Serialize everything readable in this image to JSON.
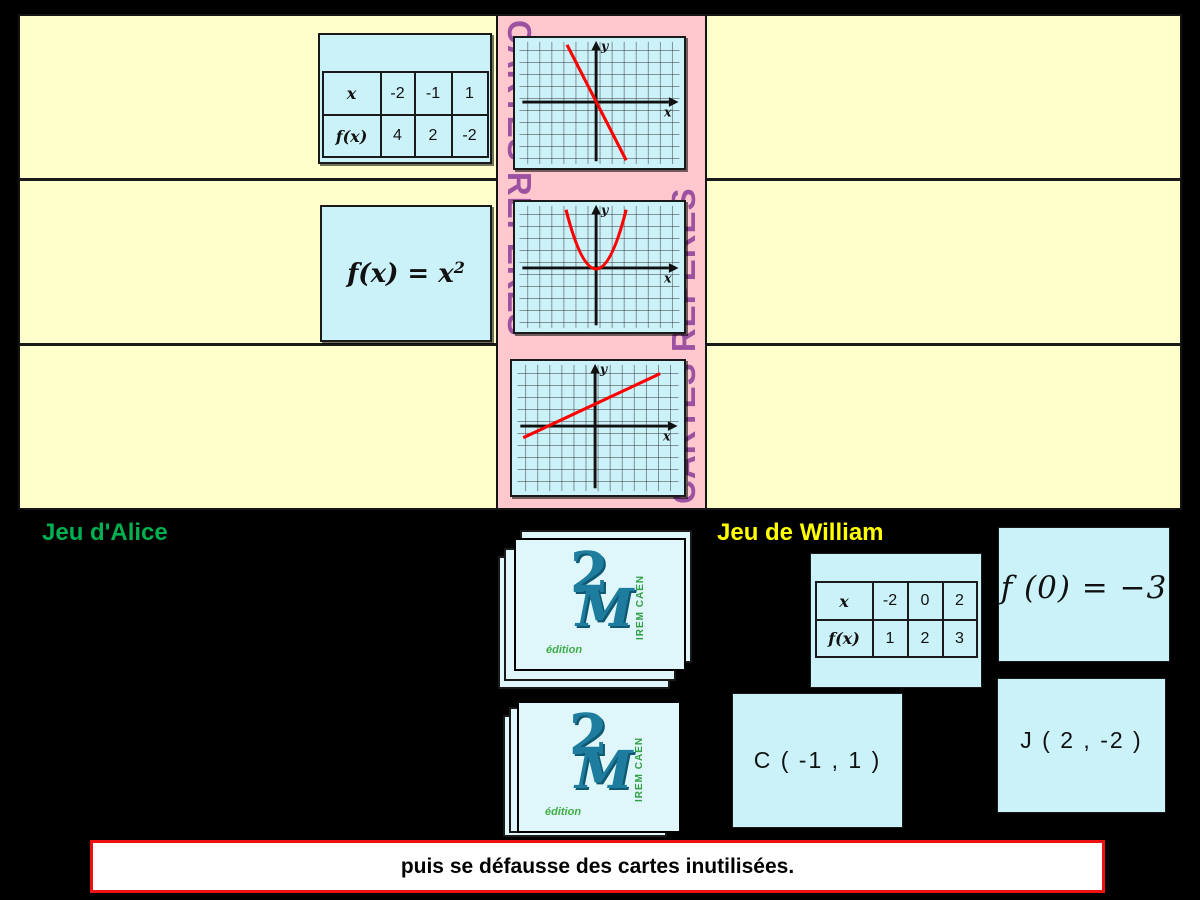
{
  "titles": {
    "alice": "Jeu d'Alice",
    "william": "Jeu de William"
  },
  "center_column": {
    "left_vertical_text": "CARTES REPÈRES",
    "right_vertical_text": "CARTES REPÈRES"
  },
  "board": {
    "row1_table": {
      "header_row": [
        "x",
        "-2",
        "-1",
        "1"
      ],
      "value_row": [
        "f(x)",
        "4",
        "2",
        "-2"
      ]
    },
    "row2_formula": {
      "base": "f(x) = x",
      "exponent": "2"
    }
  },
  "graphs": {
    "x_label": "x",
    "y_label": "y",
    "row1": {
      "type": "line",
      "trend": "steep decreasing line through origin",
      "points_grid": [
        [
          -2.4,
          4.8
        ],
        [
          2.5,
          -4.8
        ]
      ]
    },
    "row2": {
      "type": "parabola",
      "opens": "up",
      "vertex_grid": [
        0,
        0
      ],
      "arm_top_grid": [
        [
          -2.5,
          5
        ],
        [
          2.5,
          5
        ]
      ]
    },
    "row3": {
      "type": "line",
      "trend": "increasing shallow line",
      "points_grid": [
        [
          -6,
          -1
        ],
        [
          5.4,
          4.3
        ]
      ],
      "x_intercept_grid": -4
    }
  },
  "william_cards": {
    "table": {
      "header_row": [
        "x",
        "-2",
        "0",
        "2"
      ],
      "value_row": [
        "f(x)",
        "1",
        "2",
        "3"
      ]
    },
    "value_card": "f (0) = −3",
    "point_card_c": "C ( -1 , 1 )",
    "point_card_j": "J ( 2 , -2 )"
  },
  "logo": {
    "digit": "2",
    "letter": "M",
    "institute": "IREM CAEN",
    "edition": "édition"
  },
  "footer": {
    "text": "puis se défausse des cartes inutilisées."
  },
  "colors": {
    "board_bg": "#FFFFCC",
    "center_bg": "#FFC7CE",
    "vertical_text": "#9C51A1",
    "card_bg": "#CBF1F9",
    "stack_card_bg": "#DFF7FA",
    "curve_red": "#FF0000",
    "alice_green": "#00B050",
    "william_yellow": "#FFFF00",
    "footer_border": "#EE1111",
    "logo_teal": "#1E7D9E",
    "logo_green": "#2FA043"
  }
}
